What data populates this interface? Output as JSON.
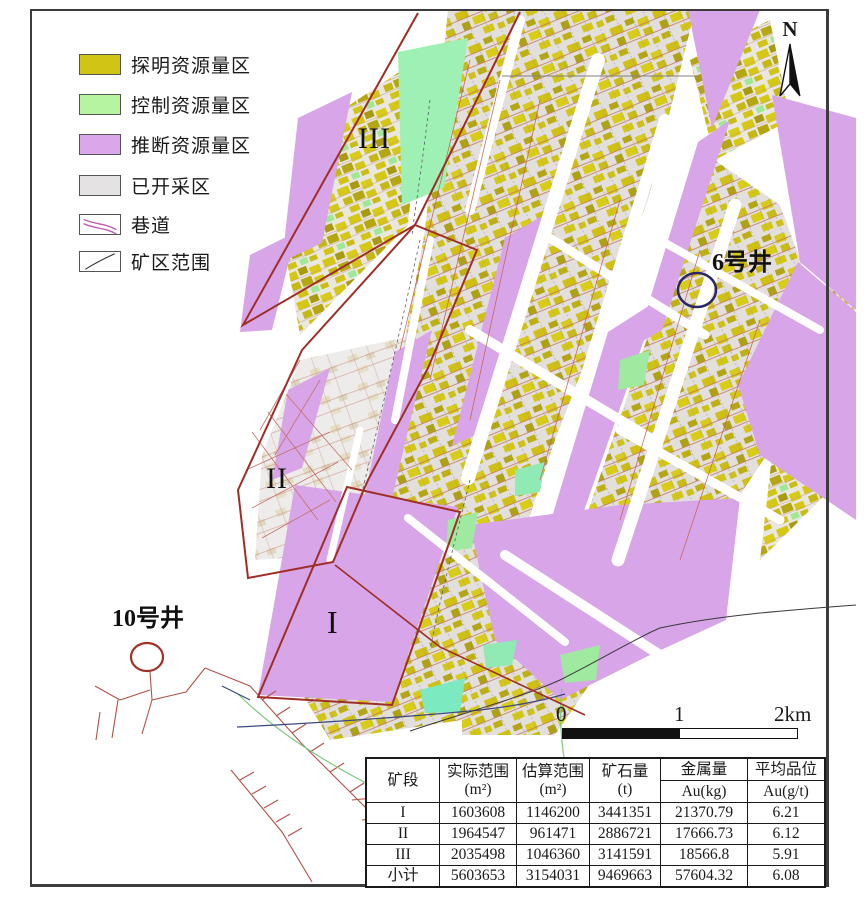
{
  "compass": {
    "label": "N"
  },
  "legend": {
    "items": [
      {
        "label": "探明资源量区",
        "color": "#d2c414"
      },
      {
        "label": "控制资源量区",
        "color": "#b6f4a0"
      },
      {
        "label": "推断资源量区",
        "color": "#dca6ea"
      },
      {
        "label": "已开采区",
        "color": "#e4e2e3"
      },
      {
        "label": "巷道",
        "color": "#c05ab0"
      },
      {
        "label": "矿区范围",
        "color": "#333333"
      }
    ]
  },
  "map_labels": {
    "zone1": "I",
    "zone2": "II",
    "zone3": "III",
    "well6": "6号井",
    "well10": "10号井"
  },
  "scale_bar": {
    "tick0": "0",
    "tick1": "1",
    "tick2": "2km"
  },
  "table": {
    "headers": {
      "col1": "矿段",
      "col2_name": "实际范围",
      "col2_unit": "(m²)",
      "col3_name": "估算范围",
      "col3_unit": "(m²)",
      "col4_name": "矿石量",
      "col4_unit": "(t)",
      "col5_name": "金属量",
      "col5_unit": "Au(kg)",
      "col6_name": "平均品位",
      "col6_unit": "Au(g/t)"
    },
    "rows": [
      {
        "zone": "I",
        "actual_area": "1603608",
        "estimated_area": "1146200",
        "ore_tonnage": "3441351",
        "metal_au_kg": "21370.79",
        "avg_grade": "6.21"
      },
      {
        "zone": "II",
        "actual_area": "1964547",
        "estimated_area": "961471",
        "ore_tonnage": "2886721",
        "metal_au_kg": "17666.73",
        "avg_grade": "6.12"
      },
      {
        "zone": "III",
        "actual_area": "2035498",
        "estimated_area": "1046360",
        "ore_tonnage": "3141591",
        "metal_au_kg": "18566.8",
        "avg_grade": "5.91"
      },
      {
        "zone": "小计",
        "actual_area": "5603653",
        "estimated_area": "3154031",
        "ore_tonnage": "9469663",
        "metal_au_kg": "57604.32",
        "avg_grade": "6.08"
      }
    ]
  },
  "colors": {
    "proven_yellow": "#d2c414",
    "controlled_green": "#b6f4a0",
    "inferred_purple": "#d8a5e8",
    "mined_gray": "#e2dfdd",
    "zone_outline_red": "#9e2e26",
    "tunnel_red": "#b0524a",
    "well6_circle_blue": "#2d2464",
    "well10_circle_red": "#a03227",
    "boundary_black": "#3a3a3a"
  }
}
